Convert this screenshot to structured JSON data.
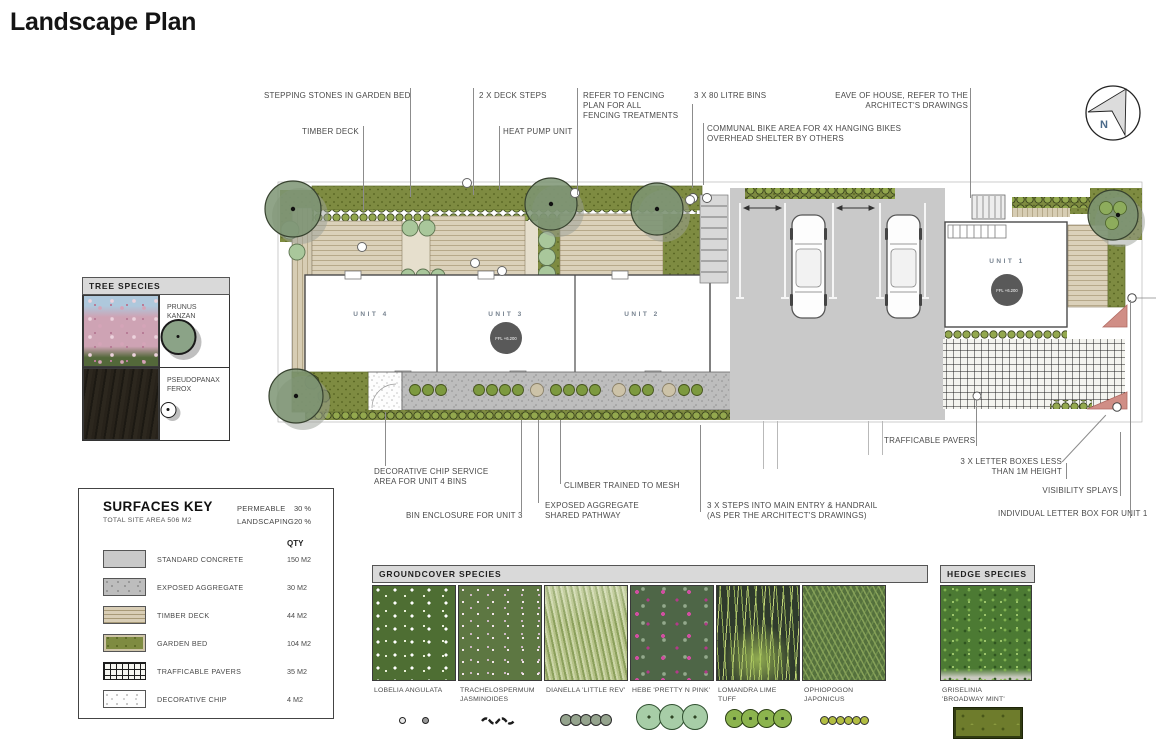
{
  "page": {
    "title": "Landscape Plan"
  },
  "compass": {
    "north_label": "N"
  },
  "annotations": {
    "top": [
      {
        "text": "STEPPING STONES IN GARDEN BED"
      },
      {
        "text": "TIMBER DECK"
      },
      {
        "text": "2 X DECK STEPS"
      },
      {
        "text": "HEAT PUMP UNIT"
      },
      {
        "text": "REFER TO FENCING\nPLAN FOR ALL\nFENCING TREATMENTS"
      },
      {
        "text": "3 X 80 LITRE BINS"
      },
      {
        "text": "COMMUNAL BIKE AREA FOR 4X HANGING BIKES\nOVERHEAD SHELTER BY OTHERS"
      },
      {
        "text": "EAVE OF HOUSE, REFER TO THE\nARCHITECT'S DRAWINGS"
      }
    ],
    "bottom": [
      {
        "text": "DECORATIVE CHIP SERVICE\nAREA FOR UNIT 4 BINS"
      },
      {
        "text": "BIN ENCLOSURE FOR UNIT 3"
      },
      {
        "text": "CLIMBER TRAINED TO MESH"
      },
      {
        "text": "EXPOSED AGGREGATE\nSHARED PATHWAY"
      },
      {
        "text": "3 X STEPS INTO MAIN ENTRY & HANDRAIL\n(AS PER THE ARCHITECT'S DRAWINGS)"
      },
      {
        "text": "TRAFFICABLE PAVERS"
      },
      {
        "text": "3 X LETTER BOXES LESS\nTHAN 1M HEIGHT"
      },
      {
        "text": "VISIBILITY SPLAYS"
      },
      {
        "text": "INDIVIDUAL LETTER BOX FOR UNIT 1"
      }
    ]
  },
  "plan": {
    "units": [
      {
        "label": "UNIT 4"
      },
      {
        "label": "UNIT 3",
        "ffl": "FFL +6.200"
      },
      {
        "label": "UNIT 2"
      },
      {
        "label": "UNIT 1",
        "ffl": "FFL +6.200"
      }
    ]
  },
  "tree_species": {
    "title": "TREE SPECIES",
    "items": [
      {
        "name": "PRUNUS\nKANZAN"
      },
      {
        "name": "PSEUDOPANAX\nFEROX"
      }
    ]
  },
  "surfaces_key": {
    "title": "SURFACES KEY",
    "subtitle": "TOTAL SITE AREA 506 M2",
    "stats": [
      {
        "label": "PERMEABLE",
        "value": "30 %"
      },
      {
        "label": "LANDSCAPING",
        "value": "20 %"
      }
    ],
    "qty_header": "QTY",
    "rows": [
      {
        "label": "STANDARD CONCRETE",
        "qty": "150 M2"
      },
      {
        "label": "EXPOSED AGGREGATE",
        "qty": "30 M2"
      },
      {
        "label": "TIMBER DECK",
        "qty": "44 M2"
      },
      {
        "label": "GARDEN BED",
        "qty": "104 M2"
      },
      {
        "label": "TRAFFICABLE PAVERS",
        "qty": "35 M2"
      },
      {
        "label": "DECORATIVE CHIP",
        "qty": "4 M2"
      }
    ]
  },
  "groundcover_species": {
    "title": "GROUNDCOVER SPECIES",
    "items": [
      {
        "name": "LOBELIA ANGULATA"
      },
      {
        "name": "TRACHELOSPERMUM\nJASMINOIDES"
      },
      {
        "name": "DIANELLA 'LITTLE REV'"
      },
      {
        "name": "HEBE 'PRETTY N PINK'"
      },
      {
        "name": "LOMANDRA LIME\nTUFF"
      },
      {
        "name": "OPHIOPOGON\nJAPONICUS"
      }
    ]
  },
  "hedge_species": {
    "title": "HEDGE SPECIES",
    "items": [
      {
        "name": "GRISELINIA\n'BROADWAY MINT'"
      }
    ]
  },
  "colors": {
    "garden_bed": "#7e8b41",
    "tree_canopy": "#7c9473",
    "timber_deck": "#d9ceb6",
    "concrete": "#c9c9c9",
    "exposed_aggregate": "#bdbdbd",
    "trafficable_paver_grid": "#1c1c1c",
    "visibility_splay": "#d08e86",
    "ffl_badge": "#595959",
    "unit_label": "#76828f"
  }
}
